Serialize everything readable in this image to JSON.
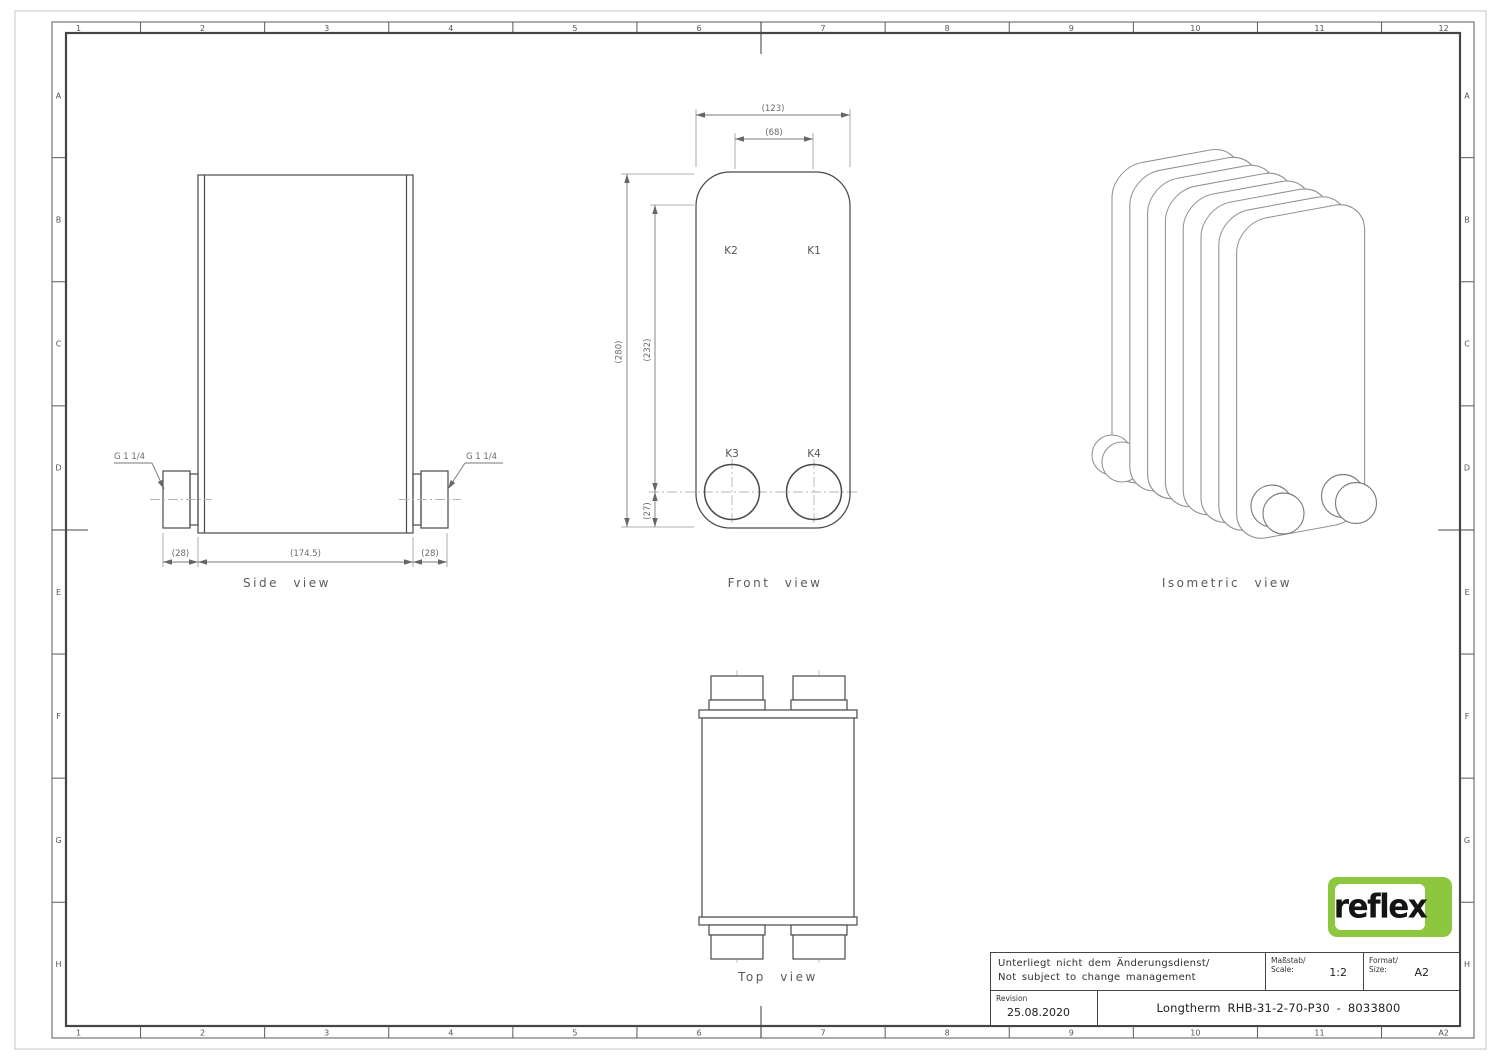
{
  "ruler": {
    "cols_top": [
      "1",
      "2",
      "3",
      "4",
      "5",
      "6",
      "7",
      "8",
      "9",
      "10",
      "11",
      "12"
    ],
    "cols_bottom": [
      "1",
      "2",
      "3",
      "4",
      "5",
      "6",
      "7",
      "8",
      "9",
      "10",
      "11",
      "A2"
    ],
    "rows_left": [
      "A",
      "B",
      "C",
      "D",
      "E",
      "F",
      "G",
      "H"
    ],
    "rows_right": [
      "A",
      "B",
      "C",
      "D",
      "E",
      "F",
      "G",
      "H"
    ]
  },
  "side_view": {
    "caption": "Side view",
    "thread_left": "G 1 1/4",
    "thread_right": "G 1 1/4",
    "dim_left": "(28)",
    "dim_width": "(174.5)",
    "dim_right": "(28)"
  },
  "front_view": {
    "caption": "Front view",
    "k1": "K1",
    "k2": "K2",
    "k3": "K3",
    "k4": "K4",
    "dim_width": "(123)",
    "dim_ports_h": "(68)",
    "dim_height": "(280)",
    "dim_ports_v": "(232)",
    "dim_port_bottom": "(27)"
  },
  "top_view": {
    "caption": "Top view"
  },
  "iso_view": {
    "caption": "Isometric view"
  },
  "title_block": {
    "note_line1": "Unterliegt nicht dem Änderungsdienst/",
    "note_line2": "Not subject to change management",
    "scale_label_de": "Maßstab/",
    "scale_label_en": "Scale:",
    "scale_value": "1:2",
    "format_label_de": "Format/",
    "format_label_en": "Size:",
    "format_value": "A2",
    "revision_label": "Revision",
    "revision_date": "25.08.2020",
    "drawing_title": "Longtherm RHB-31-2-70-P30 - 8033800"
  },
  "logo": {
    "text": "reflex",
    "green": "#8DC63F"
  }
}
